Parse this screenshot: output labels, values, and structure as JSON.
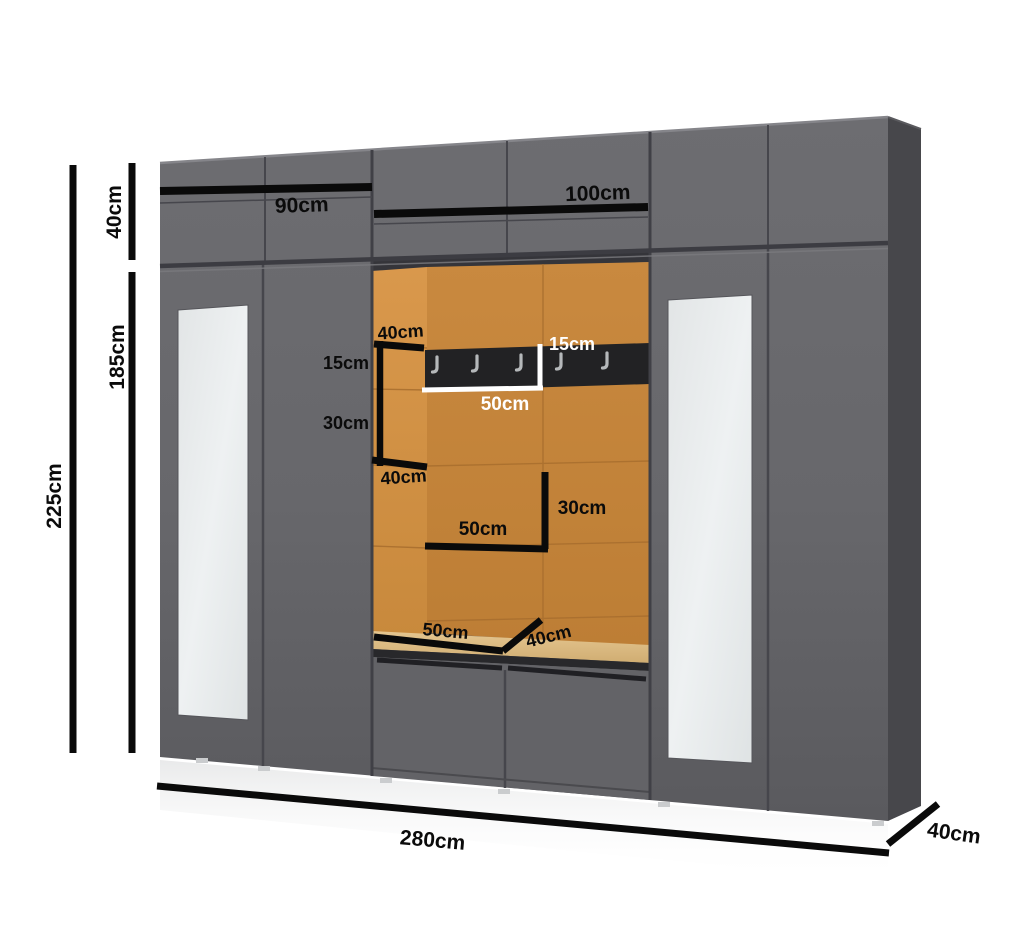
{
  "diagram": {
    "title": "wardrobe-dimension-diagram",
    "labels": {
      "height_upper": "40cm",
      "height_main": "185cm",
      "height_total": "225cm",
      "width_left": "90cm",
      "width_center": "100cm",
      "upper_shelf_depth": "40cm",
      "rail_height_left": "15cm",
      "shelf_gap": "30cm",
      "lower_shelf_depth": "40cm",
      "rail_height_right": "15cm",
      "rail_width": "50cm",
      "compartment_height": "30cm",
      "compartment_width": "50cm",
      "bench_width": "50cm",
      "bench_depth": "40cm",
      "width_total": "280cm",
      "depth_total": "40cm"
    },
    "hooks": {
      "count": 5
    },
    "colors": {
      "background": "#ffffff",
      "cabinet_front": "#67676b",
      "cabinet_side": "#47474b",
      "seam": "#46464c",
      "niche_back": "#c5863c",
      "niche_side": "#d2913f",
      "niche_ceiling": "#35353a",
      "bench_cushion": "#dcbd86",
      "hook_rail": "#222224",
      "hook_metal": "#b5b8ba",
      "mirror": "#e7eaeb",
      "dimension_line": "#0a0a0a",
      "dimension_line_white": "#ffffff"
    }
  }
}
